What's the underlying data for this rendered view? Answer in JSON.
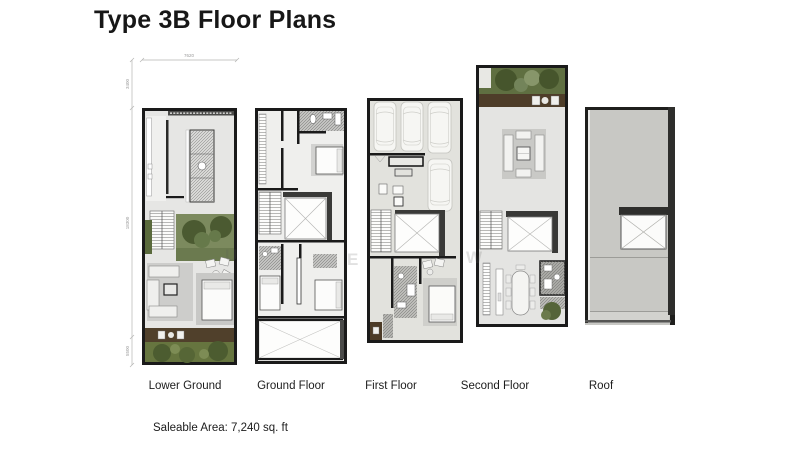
{
  "title": "Type 3B Floor Plans",
  "floors": [
    {
      "label": "Lower Ground"
    },
    {
      "label": "Ground Floor"
    },
    {
      "label": "First Floor"
    },
    {
      "label": "Second Floor"
    },
    {
      "label": "Roof"
    }
  ],
  "footer": {
    "saleable_area": "Saleable Area: 7,240 sq. ft"
  },
  "dimensions": {
    "top_width": "7620",
    "left_top": "3400",
    "left_middle": "18300",
    "left_bottom": "5500"
  },
  "watermark": {
    "letters": [
      "U",
      "E",
      "W"
    ]
  },
  "colors": {
    "wall": "#1a1a1a",
    "floor": "#e4e4e2",
    "garden_green": "#5f6f41",
    "tree_green": "#46552c",
    "deck_brown": "#4e3d29",
    "roof_gray": "#c8c8c4",
    "hatch_gray": "#bdbdb9"
  }
}
